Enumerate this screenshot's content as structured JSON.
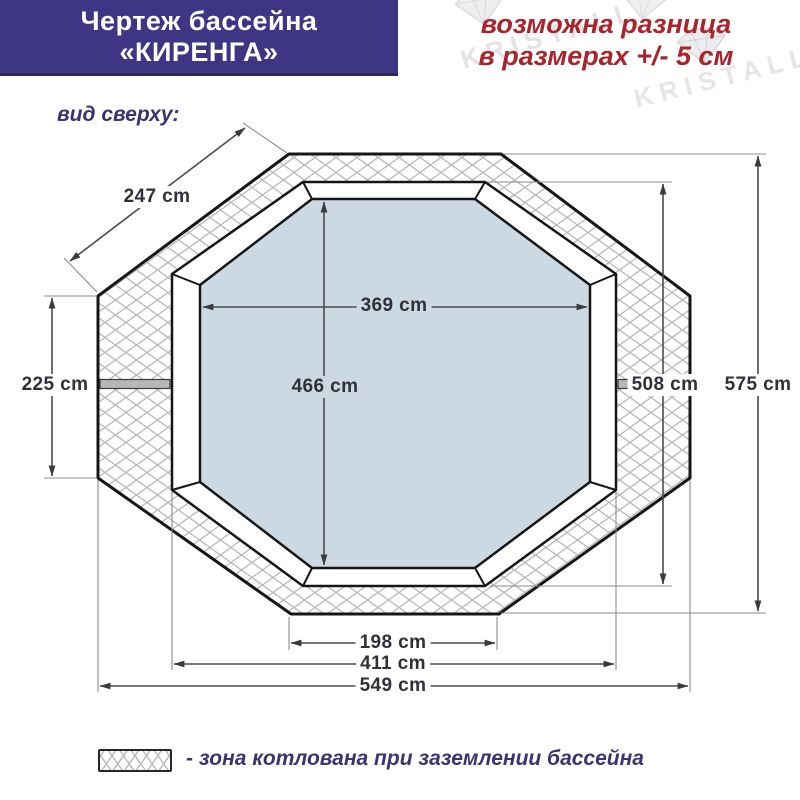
{
  "header": {
    "line1": "Чертеж бассейна",
    "line2": "«КИРЕНГА»"
  },
  "notice": {
    "line1": "возможна разница",
    "line2": "в размерах +/- 5 см"
  },
  "view_label": "вид сверху:",
  "watermark": {
    "text": "KRISTALL"
  },
  "diagram": {
    "type": "pool-top-view-technical-drawing",
    "dimensions": {
      "diagonal_edge": "247 cm",
      "side_edge": "225 cm",
      "water_width": "369 cm",
      "water_height": "466 cm",
      "bowl_height": "508 cm",
      "pit_height": "575 cm",
      "bottom_edge": "198 cm",
      "bowl_width": "411 cm",
      "pit_width": "549 cm"
    }
  },
  "legend": {
    "text": "- зона котлована при заземлении бассейна"
  },
  "colors": {
    "header_bg": "#3e3685",
    "notice_text": "#a8262b",
    "label_navy": "#3a3273",
    "water": "#ccd9e2",
    "hatch_line": "#b6b6ba",
    "outline": "#161616"
  }
}
